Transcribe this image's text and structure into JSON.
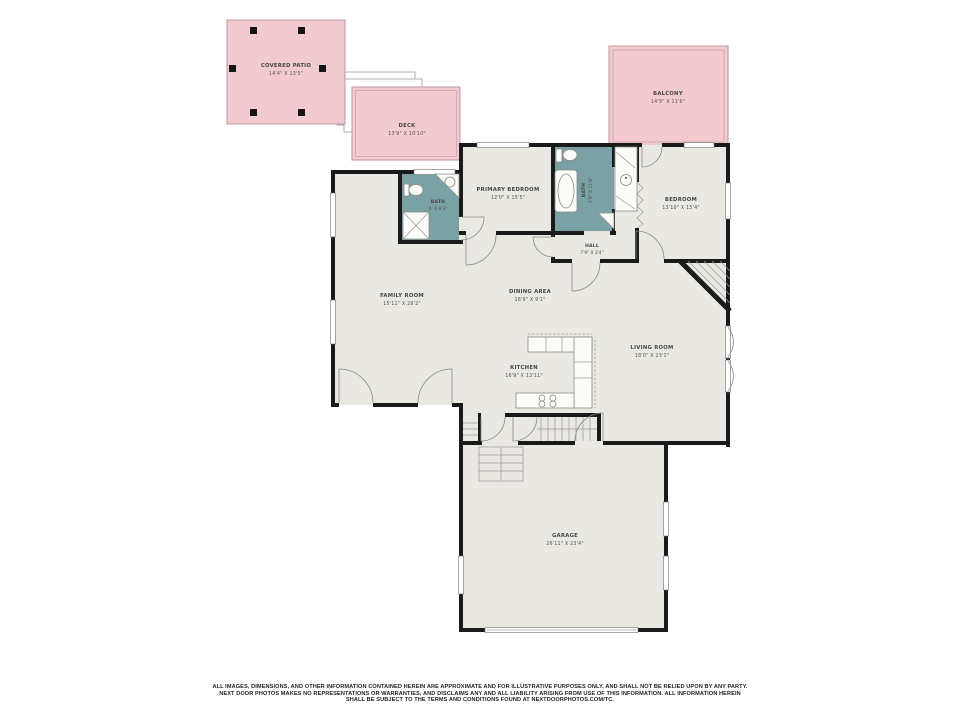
{
  "palette": {
    "outdoor_fill": "#f2cad0",
    "outdoor_border": "#b8909a",
    "floor_fill": "#e9e8e3",
    "wall_color": "#1a1a1a",
    "bath_fill": "#7aa1a4",
    "fixture_line": "#8b8b85",
    "label_color": "#474743"
  },
  "rooms": {
    "covered_patio": {
      "name": "COVERED PATIO",
      "dims": "14'4\" X 13'5\""
    },
    "deck": {
      "name": "DECK",
      "dims": "13'9\" X 10'10\""
    },
    "balcony": {
      "name": "BALCONY",
      "dims": "14'9\" X 11'6\""
    },
    "primary_bedroom": {
      "name": "PRIMARY BEDROOM",
      "dims": "12'0\" X 15'5\""
    },
    "bath_primary": {
      "name": "BATH",
      "dims": "8' X 8'3\""
    },
    "bath_hall": {
      "name": "BATH",
      "dims": "7'9\" X 11'6\""
    },
    "hall": {
      "name": "HALL",
      "dims": "7'9\" X 3'4\""
    },
    "bedroom": {
      "name": "BEDROOM",
      "dims": "13'10\" X 15'4\""
    },
    "family_room": {
      "name": "FAMILY ROOM",
      "dims": "15'11\" X 29'2\""
    },
    "dining_area": {
      "name": "DINING AREA",
      "dims": "16'9\" X 9'1\""
    },
    "kitchen": {
      "name": "KITCHEN",
      "dims": "16'9\" X 13'11\""
    },
    "living_room": {
      "name": "LIVING ROOM",
      "dims": "18'0\" X 23'1\""
    },
    "garage": {
      "name": "GARAGE",
      "dims": "26'11\" X 23'4\""
    }
  },
  "disclaimer": {
    "line1": "ALL IMAGES, DIMENSIONS, AND OTHER INFORMATION CONTAINED HEREIN ARE APPROXIMATE AND FOR ILLUSTRATIVE PURPOSES ONLY, AND SHALL NOT BE RELIED UPON BY ANY PARTY.",
    "line2": "NEXT DOOR PHOTOS MAKES NO REPRESENTATIONS OR WARRANTIES, AND DISCLAIMS ANY AND ALL LIABILITY ARISING FROM USE OF THIS INFORMATION. ALL INFORMATION HEREIN",
    "line3": "SHALL BE SUBJECT TO THE TERMS AND CONDITIONS FOUND AT NEXTDOORPHOTOS.COM/TC."
  }
}
